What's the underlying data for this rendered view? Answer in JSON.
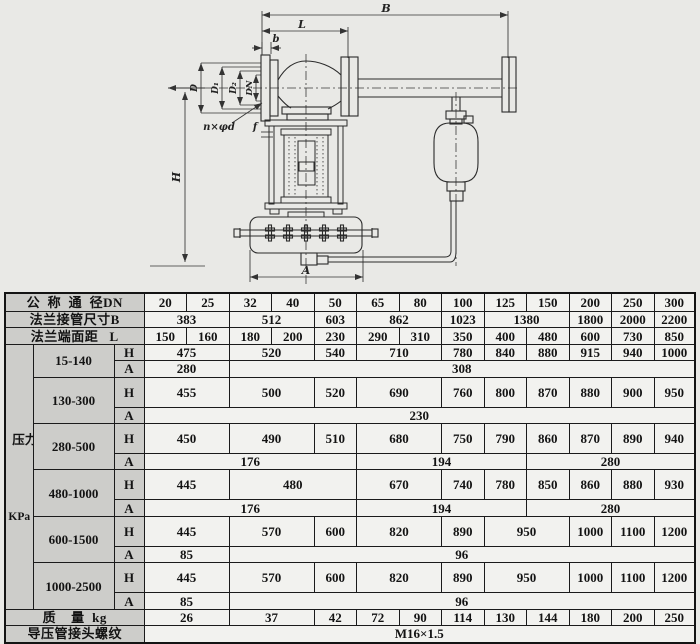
{
  "drawing": {
    "labels": {
      "b_dim": "B",
      "l_dim": "L",
      "b_small": "b",
      "d": "D",
      "d1": "D₁",
      "d2": "D₂",
      "dn": "DN",
      "n_phi_d": "n×φd",
      "f": "f",
      "h": "H",
      "a": "A"
    }
  },
  "table": {
    "dn": {
      "label": "公  称  通  径DN",
      "values": [
        "20",
        "25",
        "32",
        "40",
        "50",
        "65",
        "80",
        "100",
        "125",
        "150",
        "200",
        "250",
        "300"
      ]
    },
    "flange_b": {
      "label": "法兰接管尺寸B",
      "cells": [
        "383",
        "512",
        "603",
        "862",
        "1023",
        "1380",
        "1800",
        "2000",
        "2200"
      ]
    },
    "face_l": {
      "label": "法兰端面距   L",
      "values": [
        "150",
        "160",
        "180",
        "200",
        "230",
        "290",
        "310",
        "350",
        "400",
        "480",
        "600",
        "730",
        "850"
      ]
    },
    "pressure": {
      "side_text": "压力调节范围",
      "side_unit": "KPa",
      "h_label": "H",
      "a_label": "A",
      "groups": [
        {
          "range": "15-140",
          "h": [
            "475",
            "520",
            "540",
            "710",
            "780",
            "840",
            "880",
            "915",
            "940",
            "1000"
          ],
          "a": [
            "280",
            "308"
          ]
        },
        {
          "range": "130-300",
          "h": [
            "455",
            "500",
            "520",
            "690",
            "760",
            "800",
            "870",
            "880",
            "900",
            "950"
          ],
          "a": [
            "230"
          ]
        },
        {
          "range": "280-500",
          "h": [
            "450",
            "490",
            "510",
            "680",
            "750",
            "790",
            "860",
            "870",
            "890",
            "940"
          ],
          "a": [
            "176",
            "194",
            "280"
          ]
        },
        {
          "range": "480-1000",
          "h": [
            "445",
            "480",
            "670",
            "740",
            "780",
            "850",
            "860",
            "880",
            "930"
          ],
          "a": [
            "176",
            "194",
            "280"
          ]
        },
        {
          "range": "600-1500",
          "h": [
            "445",
            "570",
            "600",
            "820",
            "890",
            "950",
            "1000",
            "1100",
            "1200"
          ],
          "a": [
            "85",
            "96"
          ]
        },
        {
          "range": "1000-2500",
          "h": [
            "445",
            "570",
            "600",
            "820",
            "890",
            "950",
            "1000",
            "1100",
            "1200"
          ],
          "a": [
            "85",
            "96"
          ]
        }
      ]
    },
    "mass": {
      "label": "质    量  kg",
      "cells": [
        "26",
        "37",
        "42",
        "72",
        "90",
        "114",
        "130",
        "144",
        "180",
        "200",
        "250"
      ]
    },
    "thread": {
      "label": "导压管接头螺纹",
      "value": "M16×1.5"
    }
  }
}
